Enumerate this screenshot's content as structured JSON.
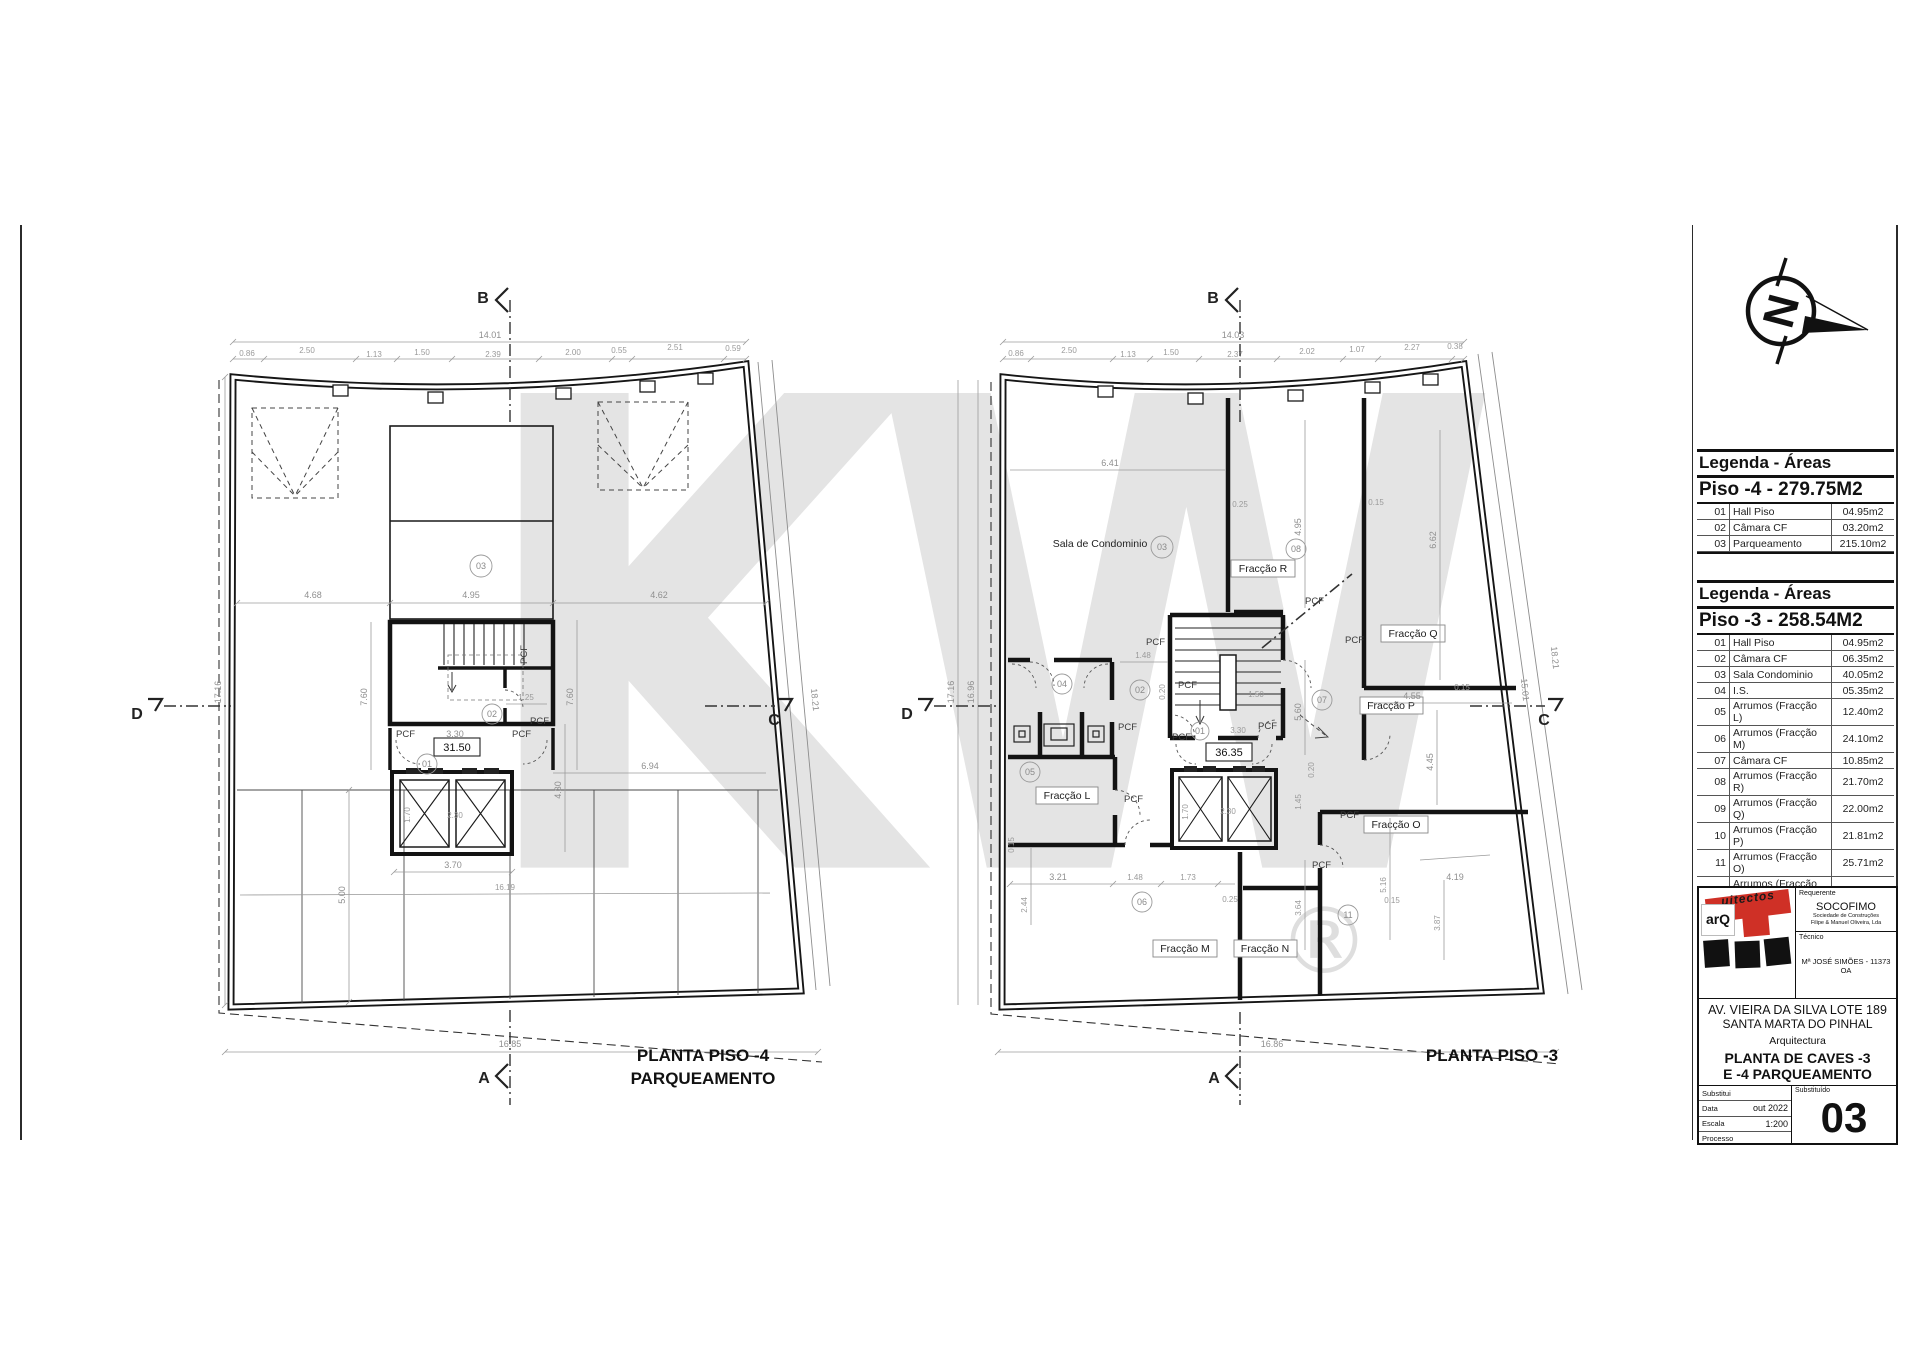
{
  "watermark": {
    "letters": "KW",
    "reg": "®"
  },
  "legend1": {
    "title": "Legenda - Áreas",
    "subtitle": "Piso -4 - 279.75M2",
    "rows": [
      {
        "num": "01",
        "label": "Hall Piso",
        "area": "04.95m2"
      },
      {
        "num": "02",
        "label": "Câmara CF",
        "area": "03.20m2"
      },
      {
        "num": "03",
        "label": "Parqueamento",
        "area": "215.10m2"
      }
    ]
  },
  "legend2": {
    "title": "Legenda - Áreas",
    "subtitle": "Piso -3 - 258.54M2",
    "rows": [
      {
        "num": "01",
        "label": "Hall Piso",
        "area": "04.95m2"
      },
      {
        "num": "02",
        "label": "Câmara CF",
        "area": "06.35m2"
      },
      {
        "num": "03",
        "label": "Sala Condominio",
        "area": "40.05m2"
      },
      {
        "num": "04",
        "label": "I.S.",
        "area": "05.35m2"
      },
      {
        "num": "05",
        "label": "Arrumos (Fracção L)",
        "area": "12.40m2"
      },
      {
        "num": "06",
        "label": "Arrumos (Fracção M)",
        "area": "24.10m2"
      },
      {
        "num": "07",
        "label": "Câmara CF",
        "area": "10.85m2"
      },
      {
        "num": "08",
        "label": "Arrumos (Fracção R)",
        "area": "21.70m2"
      },
      {
        "num": "09",
        "label": "Arrumos (Fracção Q)",
        "area": "22.00m2"
      },
      {
        "num": "10",
        "label": "Arrumos (Fracção P)",
        "area": "21.81m2"
      },
      {
        "num": "11",
        "label": "Arrumos (Fracção O)",
        "area": "25.71m2"
      },
      {
        "num": "12",
        "label": "Arrumos (Fracção N)",
        "area": "16.10m2"
      }
    ]
  },
  "titleblock": {
    "logo_arq": "arQ",
    "logo_rest": "uitectos",
    "requerente_label": "Requerente",
    "requerente_name": "SOCOFIMO",
    "requerente_sub1": "Sociedade de Construções",
    "requerente_sub2": "Filipe & Manuel Oliveira, Lda",
    "tecnico_label": "Técnico",
    "tecnico_name": "Mª JOSÉ SIMÕES - 11373 OA",
    "address1": "AV. VIEIRA DA SILVA LOTE 189",
    "address2": "SANTA MARTA DO PINHAL",
    "discipline": "Arquitectura",
    "sheet_title1": "PLANTA DE CAVES -3",
    "sheet_title2": "E -4 PARQUEAMENTO",
    "substitui_label": "Substitui",
    "substituido_label": "Substituído",
    "data_label": "Data",
    "data_value": "out 2022",
    "escala_label": "Escala",
    "escala_value": "1:200",
    "processo_label": "Processo",
    "sheet_number": "03"
  },
  "north": {
    "letter": "N"
  },
  "plan4": {
    "title1": "PLANTA PISO -4",
    "title2": "PARQUEAMENTO",
    "markers": {
      "a": "A",
      "b": "B",
      "c": "C",
      "d": "D"
    },
    "level": "31.50",
    "pcf": "PCF",
    "rooms": {
      "r01": "01",
      "r02": "02",
      "r03": "03"
    },
    "dims": {
      "top_total": "14.01",
      "seg": [
        "0.86",
        "2.50",
        "1.13",
        "1.50",
        "2.39",
        "2.00",
        "0.55",
        "2.51",
        "0.59"
      ],
      "mid": [
        "4.68",
        "4.95",
        "4.62"
      ],
      "left_v": "17.16",
      "right_diag": "18.21",
      "h760l": "7.60",
      "h330": "3.30",
      "h125": "1.25",
      "h760r": "7.60",
      "v430": "4.30",
      "h694": "6.94",
      "h370": "3.70",
      "v500": "5.00",
      "h1619": "16.19",
      "bottom": "16.85",
      "v170": "1.70",
      "h230": "2.30"
    }
  },
  "plan3": {
    "title": "PLANTA PISO -3",
    "markers": {
      "a": "A",
      "b": "B",
      "c": "C",
      "d": "D"
    },
    "level": "36.35",
    "pcf": "PCF",
    "sala": "Sala de Condominio",
    "frac": {
      "l": "Fracção L",
      "m": "Fracção M",
      "n": "Fracção N",
      "o": "Fracção O",
      "p": "Fracção P",
      "q": "Fracção Q",
      "r": "Fracção R"
    },
    "rooms": {
      "r01": "01",
      "r02": "02",
      "r03": "03",
      "r04": "04",
      "r05": "05",
      "r06": "06",
      "r07": "07",
      "r08": "08",
      "r11": "11"
    },
    "dims": {
      "top_total": "14.03",
      "seg": [
        "0.86",
        "2.50",
        "1.13",
        "1.50",
        "2.37",
        "2.02",
        "1.07",
        "2.27",
        "0.38"
      ],
      "left_v1": "17.16",
      "left_v2": "16.96",
      "right_diag1": "15.01",
      "right_diag2": "18.21",
      "h641": "6.41",
      "h025a": "0.25",
      "v495": "4.95",
      "v015a": "0.15",
      "v662": "6.62",
      "h148": "1.48",
      "v020a": "0.20",
      "h330": "3.30",
      "h150": "1.50",
      "v560": "5.60",
      "h455": "4.55",
      "v445": "4.45",
      "v015b": "0.15",
      "v145": "1.45",
      "v020b": "0.20",
      "v015c": "0.15",
      "h321": "3.21",
      "h148b": "1.48",
      "h173": "1.73",
      "h025b": "0.25",
      "v244": "2.44",
      "v364": "3.64",
      "v516": "5.16",
      "h419": "4.19",
      "h015d": "0.15",
      "v387": "3.87",
      "bottom": "16.86",
      "v170": "1.70",
      "h230": "2.30"
    }
  }
}
